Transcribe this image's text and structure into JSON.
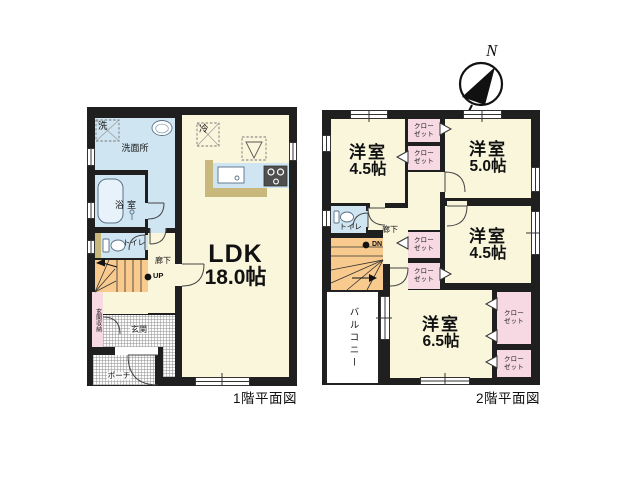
{
  "compass": {
    "north": "N"
  },
  "floor1": {
    "caption": "1階平面図",
    "labels": {
      "ldk_name": "LDK",
      "ldk_size": "18.0帖",
      "washroom": "洗面所",
      "washer": "洗",
      "fridge": "冷",
      "bath": "浴室",
      "toilet": "トイレ",
      "hallway": "廊下",
      "stairs": "UP",
      "entrance_storage": "玄関収納",
      "entrance": "玄関",
      "porch": "ポーチ"
    }
  },
  "floor2": {
    "caption": "2階平面図",
    "labels": {
      "bedroom_nw_name": "洋室",
      "bedroom_nw_size": "4.5帖",
      "bedroom_ne_name": "洋室",
      "bedroom_ne_size": "5.0帖",
      "bedroom_e_name": "洋室",
      "bedroom_e_size": "4.5帖",
      "bedroom_s_name": "洋室",
      "bedroom_s_size": "6.5帖",
      "closet_top": "クロー",
      "closet_bottom": "ゼット",
      "toilet": "トイレ",
      "hallway": "廊下",
      "stairs": "DN",
      "balcony": "バルコニー"
    }
  },
  "colors": {
    "wall": "#1f1f1f",
    "floor": "#faf6dc",
    "wet_area": "#cfe5f2",
    "closet": "#f7d9e3",
    "stairs": "#f8ca8e",
    "counter": "#c9b87b"
  }
}
